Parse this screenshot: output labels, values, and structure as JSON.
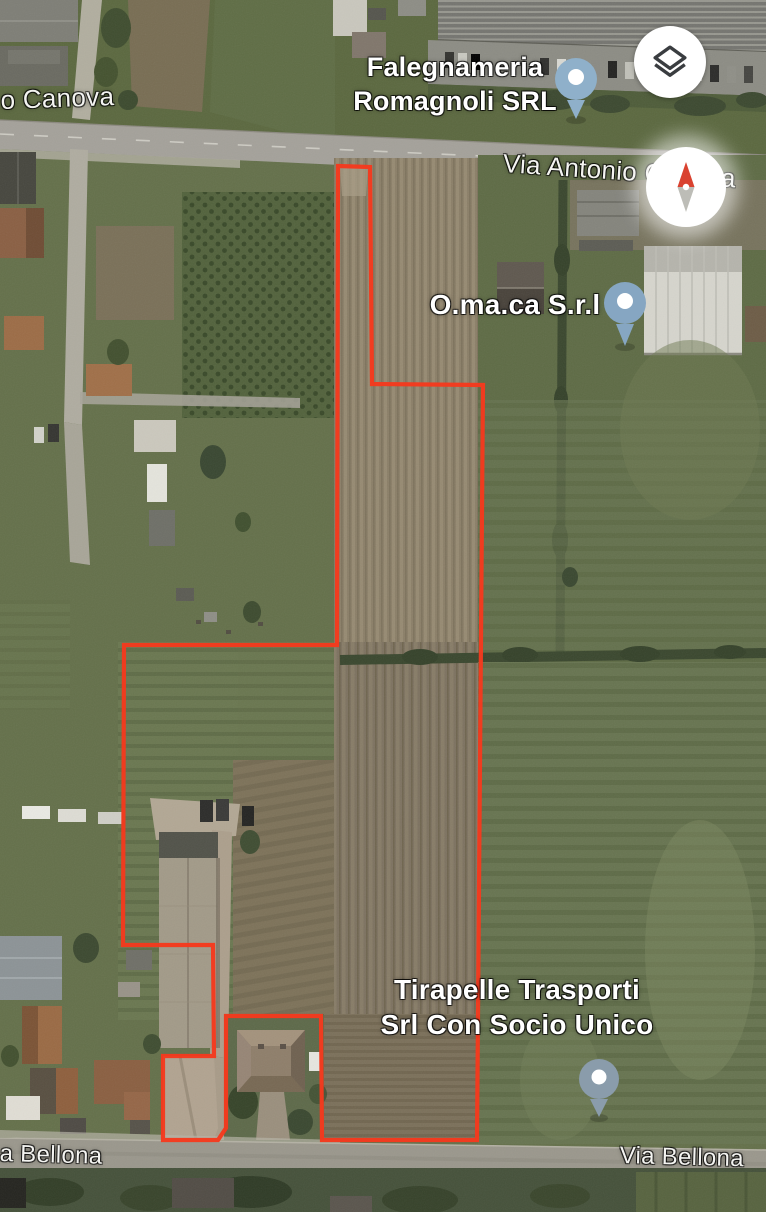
{
  "app": {
    "view": "satellite-map"
  },
  "roads": {
    "canova_left": "o Canova",
    "canova_right": "Via Antonio Canova",
    "bellona_left": "a Bellona",
    "bellona_right": "Via Bellona"
  },
  "places": {
    "falegnameria": {
      "line1": "Falegnameria",
      "line2": "Romagnoli SRL"
    },
    "omaca": {
      "line1": "O.ma.ca S.r.l"
    },
    "tirapelle": {
      "line1": "Tirapelle Trasporti",
      "line2": "Srl Con Socio Unico"
    }
  },
  "parcel": {
    "outline_color": "#f5391d",
    "points": "338,166 370,167 372,384 483,385 477,1140 322,1140 321,1016 226,1016 226,1128 218,1140 163,1140 163,1056 214,1056 213,945 123,945 124,645 337,645"
  },
  "pins": {
    "falegnameria": {
      "color": "#8fb0ca"
    },
    "omaca": {
      "color": "#86a6c2"
    },
    "tirapelle": {
      "color": "#8a9cab"
    }
  },
  "controls": {
    "layers": {
      "icon": "layers-icon",
      "color": "#3a3d40"
    },
    "compass": {
      "icon": "compass-icon",
      "north_color": "#d94230",
      "south_color": "#bdbdb7"
    }
  }
}
